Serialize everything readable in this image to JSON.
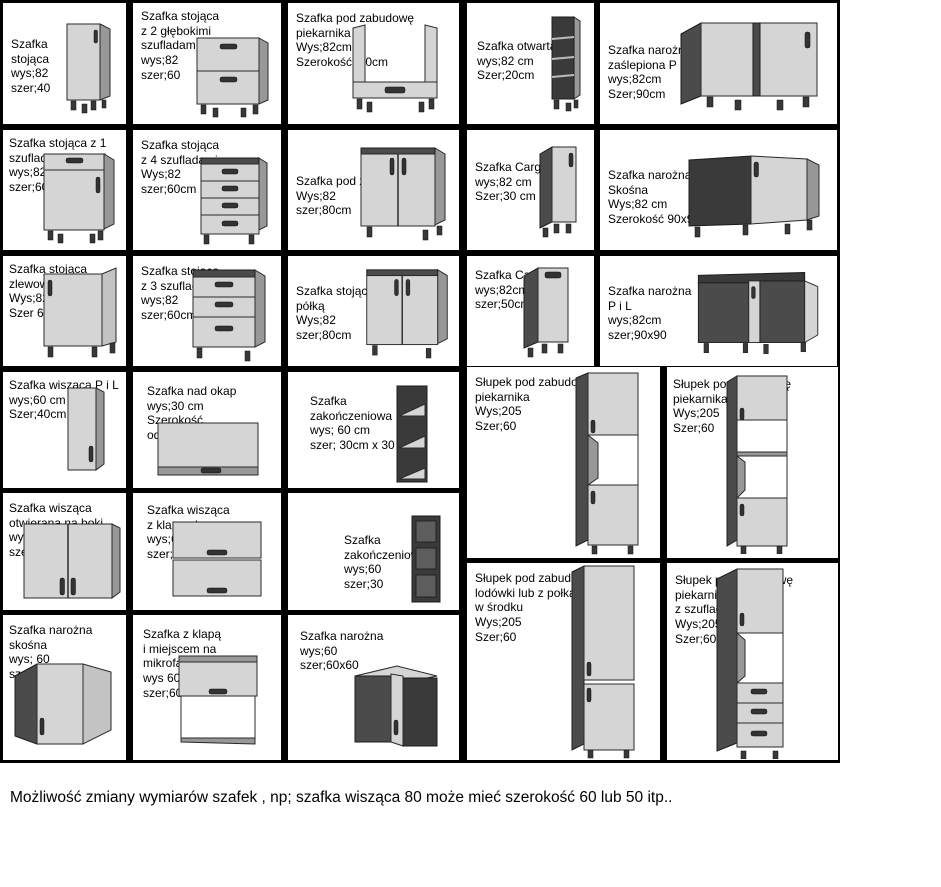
{
  "colors": {
    "grid_background": "#000000",
    "cell_background": "#ffffff",
    "cabinet_light": "#d5d5d5",
    "cabinet_dark": "#4b4b4b",
    "text": "#000000"
  },
  "footer": {
    "text": "Możliwość zmiany wymiarów szafek , np; szafka wisząca 80 może mieć szerokość 60 lub 50 itp.."
  },
  "cells": [
    {
      "id": "base-cabinet-40",
      "text": "Szafka\nstojąca\nwys;82\nszer;40",
      "illustration": "base-cabinet-single-door"
    },
    {
      "id": "base-2-deep-drawers",
      "text": "Szafka stojąca\nz 2 głębokimi\nszufladami\nwys;82\nszer;60",
      "illustration": "cabinet-two-deep-drawers"
    },
    {
      "id": "oven-housing-base",
      "text": "Szafka pod zabudowę\npiekarnika\nWys;82cm\nSzerokość; 60cm",
      "illustration": "built-in-oven-base-frame"
    },
    {
      "id": "open-cabinet-20",
      "text": "Szafka otwarta\nwys;82 cm\nSzer;20cm",
      "illustration": "narrow-open-shelf-unit"
    },
    {
      "id": "corner-blind",
      "text": "Szafka narożna\nzaślepiona P i L\nwys;82cm\nSzer;90cm",
      "illustration": "blind-corner-cabinet"
    },
    {
      "id": "base-1-drawer-door",
      "text": "Szafka stojąca z 1\nszufladą i dzwiami\nwys;82\nszer;60cm",
      "illustration": "cabinet-drawer-and-door"
    },
    {
      "id": "base-4-drawers",
      "text": "Szafka stojąca\nz 4 szufladami\nWys;82\nszer;60cm",
      "illustration": "cabinet-four-drawers"
    },
    {
      "id": "sink-base-80",
      "text": "Szafka pod zlew\nWys;82\nszer;80cm",
      "illustration": "double-door-sink-cabinet"
    },
    {
      "id": "cargo-30",
      "text": "Szafka Cargo\nwys;82 cm\nSzer;30 cm",
      "illustration": "narrow-cargo-cabinet"
    },
    {
      "id": "corner-diagonal-base",
      "text": "Szafka narożna\nSkośna\nWys;82 cm\nSzerokość 90x90 cm",
      "illustration": "diagonal-corner-cabinet"
    },
    {
      "id": "sink-base-60",
      "text": "Szafka stojąca\nzlewowa\nWys;82\nSzer 60cm",
      "illustration": "sink-cabinet-single-door"
    },
    {
      "id": "base-3-drawers",
      "text": "Szafka stojąca\nz 3 szufladami\nwys;82\nszer;60cm",
      "illustration": "cabinet-three-drawers"
    },
    {
      "id": "base-with-shelf",
      "text": "Szafka stojąca z\npółką\nWys;82\nszer;80cm",
      "illustration": "double-door-shelf-cabinet"
    },
    {
      "id": "cargo-50",
      "text": "Szafka Cargo\nwys;82cm\nszer;50cm",
      "illustration": "wide-cargo-cabinet"
    },
    {
      "id": "corner-pl-base",
      "text": "Szafka narożna\nP i L\nwys;82cm\nszer;90x90",
      "illustration": "corner-cabinet-left-right"
    },
    {
      "id": "wall-cabinet-pl",
      "text": "Szafka wisząca P i L\nwys;60 cm\nSzer;40cm",
      "illustration": "wall-cabinet-single-door"
    },
    {
      "id": "hood-wall-cabinet",
      "text": "Szafka nad okap\nwys;30 cm\nSzerokość\nod 40 cm do 60 cm",
      "illustration": "over-hood-cabinet"
    },
    {
      "id": "end-shelf-30x30",
      "text": "Szafka\nzakończeniowa\nwys; 60 cm\nszer; 30cm x 30 cm",
      "illustration": "open-end-shelf-unit"
    },
    {
      "id": "tall-oven-column",
      "text": "Słupek pod zabudowę\npiekarnika\nWys;205\nSzer;60",
      "illustration": "tall-oven-housing-column"
    },
    {
      "id": "tall-oven-microwave-column",
      "text": "Słupek pod zabudowę\npiekarnika i mikrofali\nWys;205\nSzer;60",
      "illustration": "tall-oven-microwave-column"
    },
    {
      "id": "wall-side-opening",
      "text": "Szafka wisząca\notwierana na boki\nwys;60cm\nszer;80",
      "illustration": "wall-cabinet-double-door"
    },
    {
      "id": "wall-with-flaps",
      "text": "Szafka wisząca\nz klapami\nwys;60cm\nszer;80",
      "illustration": "wall-cabinet-two-flaps"
    },
    {
      "id": "end-shelf-60",
      "text": "Szafka\nzakończeniowa\nwys;60\nszer;30",
      "illustration": "dark-end-shelf-unit"
    },
    {
      "id": "corner-diagonal-wall",
      "text": "Szafka narożna\nskośna\nwys; 60\nszer;60x60",
      "illustration": "diagonal-corner-wall-cabinet"
    },
    {
      "id": "flap-microwave-cabinet",
      "text": "Szafka z klapą\ni miejscem na\nmikrofale\nwys 60cm\nszer;60",
      "illustration": "flap-cabinet-microwave-space"
    },
    {
      "id": "corner-wall-60x60",
      "text": "Szafka narożna\nwys;60\nszer;60x60",
      "illustration": "corner-wall-cabinet"
    },
    {
      "id": "tall-fridge-column",
      "text": "Słupek pod zabudowę\nlodówki lub z połkami\nw środku\nWys;205\nSzer;60",
      "illustration": "tall-fridge-housing-column"
    },
    {
      "id": "tall-oven-drawers-column",
      "text": "Słupek pod zabudowę\npiekarnika\nz szufladami\nWys;205\nSzer;60",
      "illustration": "tall-oven-column-with-drawers"
    }
  ]
}
